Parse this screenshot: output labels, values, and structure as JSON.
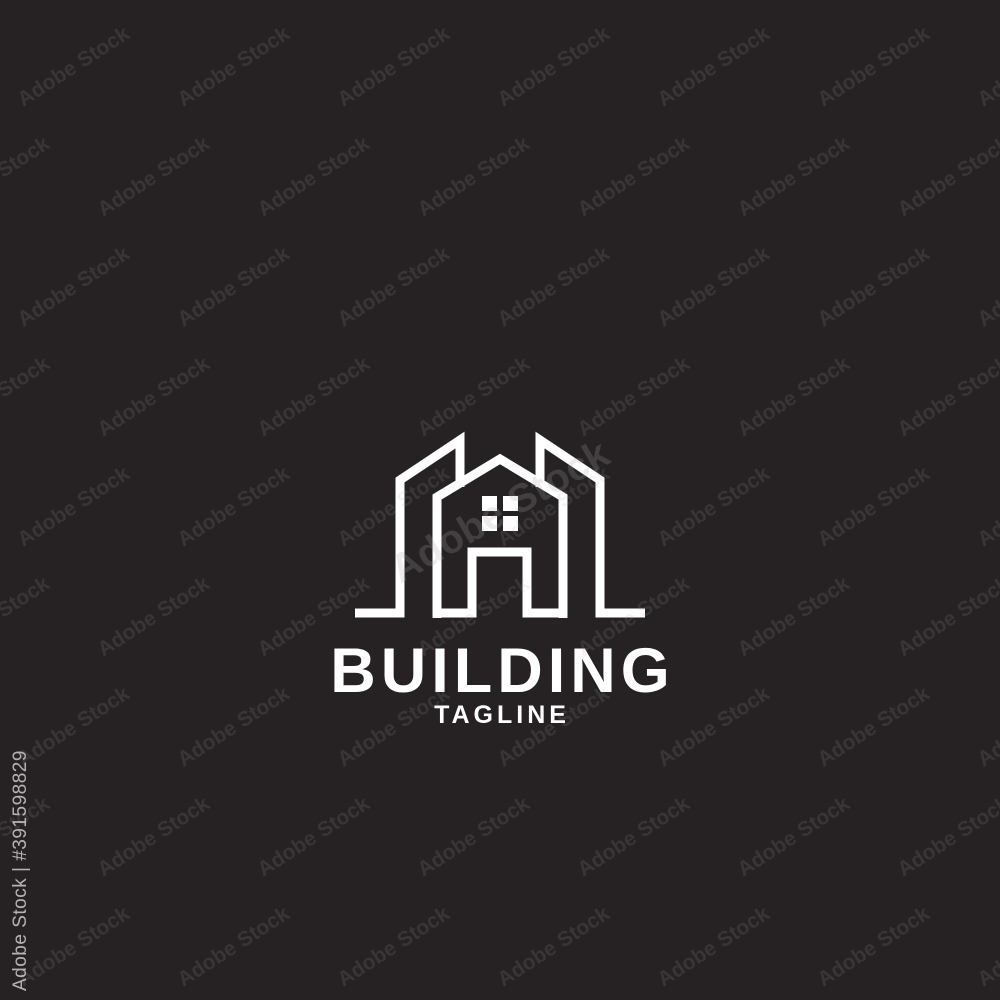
{
  "logo": {
    "brand": "BUILDING",
    "tagline": "TAGLINE",
    "icon": "building-house-line-icon",
    "stroke_color": "#ffffff"
  },
  "background_color": "#262223",
  "watermark": {
    "text": "Adobe Stock",
    "id_label": "Adobe Stock | #391598829",
    "tile_color": "rgba(170,170,170,0.15)",
    "center_color": "rgba(170,170,170,0.22)",
    "id_color": "rgba(235,235,235,0.72)"
  }
}
